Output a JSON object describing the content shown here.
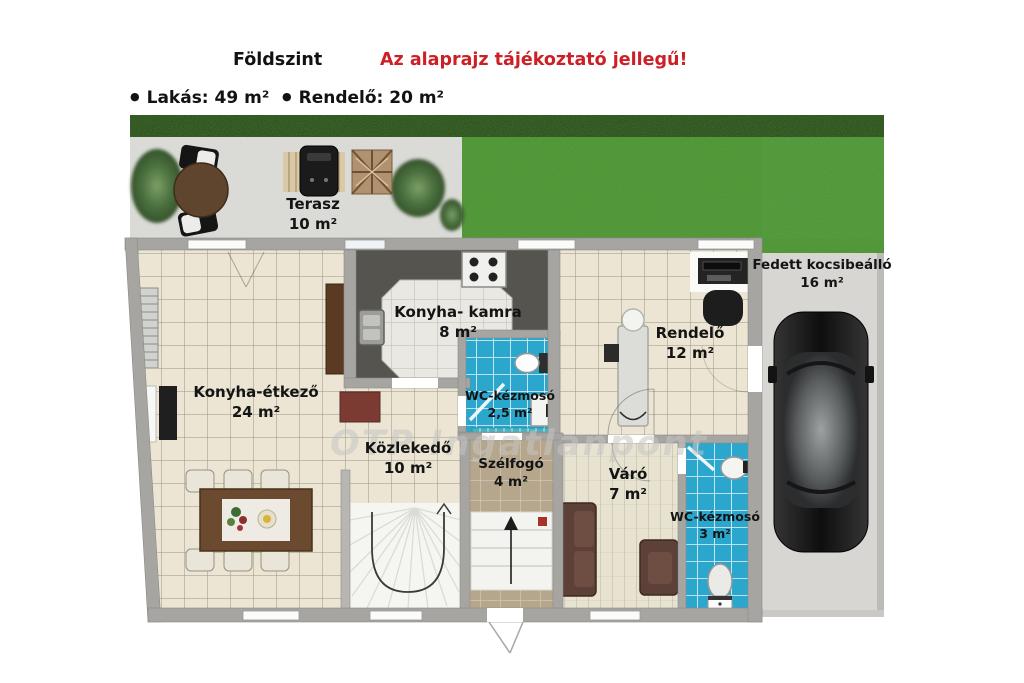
{
  "header": {
    "floor_title": "Földszint",
    "disclaimer": "Az alaprajz tájékoztató jellegű!",
    "bullets": [
      {
        "label": "Lakás: 49 m²"
      },
      {
        "label": "Rendelő: 20 m²"
      }
    ]
  },
  "watermark": "OTP Ingatlanpont",
  "rooms": [
    {
      "id": "terasz",
      "name": "Terasz",
      "area": "10 m²"
    },
    {
      "id": "konyha-kamra",
      "name": "Konyha- kamra",
      "area": "8 m²"
    },
    {
      "id": "wc-kezmoso-kicsi",
      "name": "WC-kézmosó",
      "area": "2,5 m²"
    },
    {
      "id": "rendelo",
      "name": "Rendelő",
      "area": "12 m²"
    },
    {
      "id": "konyha-etkezo",
      "name": "Konyha-étkező",
      "area": "24 m²"
    },
    {
      "id": "kozlekedo",
      "name": "Közlekedő",
      "area": "10 m²"
    },
    {
      "id": "szelfogo",
      "name": "Szélfogó",
      "area": "4 m²"
    },
    {
      "id": "varo",
      "name": "Váró",
      "area": "7 m²"
    },
    {
      "id": "wc-kezmoso-nagy",
      "name": "WC-kézmosó",
      "area": "3 m²"
    },
    {
      "id": "fedett-kocsibeallo",
      "name": "Fedett kocsibeálló",
      "area": "16 m²"
    }
  ],
  "icons": [
    "bush-icon",
    "patio-table-icon",
    "lounge-chair-icon",
    "grill-icon",
    "firewood-icon",
    "stove-icon",
    "kitchen-sink-icon",
    "toilet-icon",
    "washbasin-icon",
    "stairs-icon",
    "dining-table-icon",
    "chair-icon",
    "sofa-icon",
    "armchair-icon",
    "exam-table-icon",
    "desk-icon",
    "office-chair-icon",
    "car-icon",
    "radiator-icon",
    "entry-arrow-icon"
  ],
  "colors": {
    "disclaimer_red": "#cc2026",
    "wall_gray": "#a6a5a2",
    "floor_beige": "#ece5d3",
    "tile_blue": "#2ba7cd",
    "grass_green": "#4e9331",
    "grass_dark": "#2e4a1e",
    "entry_floor_tan": "#b6a68c",
    "furniture_wood": "#6b4a2f",
    "sofa_brown": "#5d4037",
    "terrace_gray": "#dadad6"
  }
}
